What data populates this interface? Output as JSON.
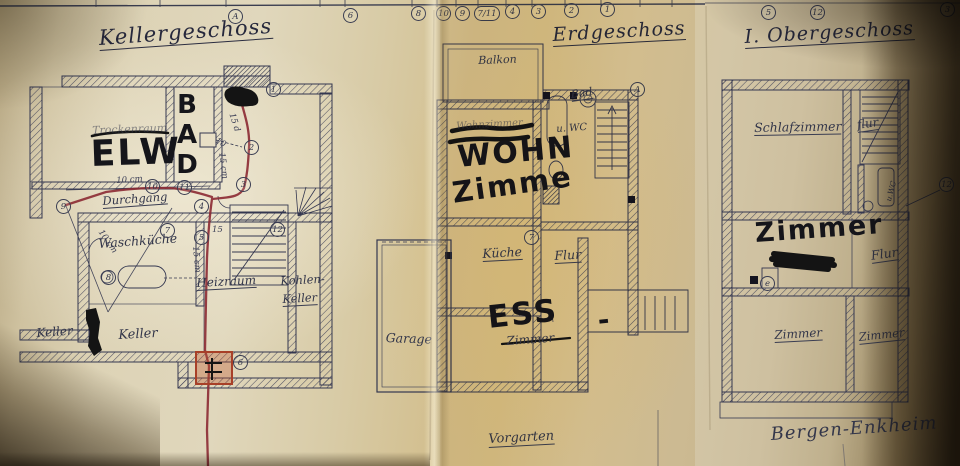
{
  "titles": {
    "keller": "Kellergeschoss",
    "erdgeschoss": "Erdgeschoss",
    "obergeschoss": "I. Obergeschoss"
  },
  "place": {
    "name": "Bergen-Enkheim",
    "front_garden": "Vorgarten"
  },
  "keller": {
    "rooms": {
      "trockenraum": "Trockenraum",
      "durchgang": "Durchgang",
      "waschkueche": "Waschküche",
      "heizraum": "Heizraum",
      "kohlen_line1": "Kohlen-",
      "kohlen_line2": "Keller",
      "keller_left": "Keller",
      "keller_mid": "Keller"
    },
    "hand": {
      "elw": "ELW",
      "bad": "BAD"
    }
  },
  "erdgeschoss": {
    "rooms": {
      "balkon": "Balkon",
      "bad": "Bad",
      "wc": "u. WC",
      "kueche": "Küche",
      "flur": "Flur",
      "zimmer": "Zimmer",
      "wohnzimmer": "Wohnzimmer",
      "garage": "Garage"
    },
    "hand": {
      "wohn": "WOHN",
      "zimme": "Zimme",
      "ess": "ESS",
      "dash": "-"
    }
  },
  "obergeschoss": {
    "rooms": {
      "schlafzimmer": "Schlafzimmer",
      "flur_top": "flur",
      "wc": "u.WC",
      "flur_mid": "Flur",
      "zimmer_bl": "Zimmer",
      "zimmer_br": "Zimmer"
    },
    "hand": {
      "zimmer": "Zimmer"
    }
  },
  "markers": {
    "t1": "A",
    "t2": "6",
    "t3": "8",
    "t4": "10",
    "t5": "9",
    "t6": "7/11",
    "t7": "4",
    "t8": "3",
    "t9": "2",
    "t10": "1",
    "t11": "5",
    "t12": "12",
    "t13": "3",
    "k1": "1",
    "k2": "2",
    "k3": "3",
    "k4": "4",
    "k5": "5",
    "k6": "6",
    "k7": "7",
    "k8": "8",
    "k9": "9",
    "k10": "10",
    "k11": "11",
    "k12": "12",
    "e1": "A",
    "e2": "7",
    "o1": "12",
    "o2": "e"
  },
  "measurements": {
    "m1": "10 cm",
    "m2": "15 d",
    "m3": "10",
    "m4": "15 cm",
    "m5": "15",
    "m6": "15 cm",
    "m7": "10 cm"
  },
  "colors": {
    "paper": "#d8c9a2",
    "plan_ink": "#343750",
    "hand_ink": "#15151a",
    "red_line": "#8c2a33",
    "red_box": "#a84028"
  }
}
